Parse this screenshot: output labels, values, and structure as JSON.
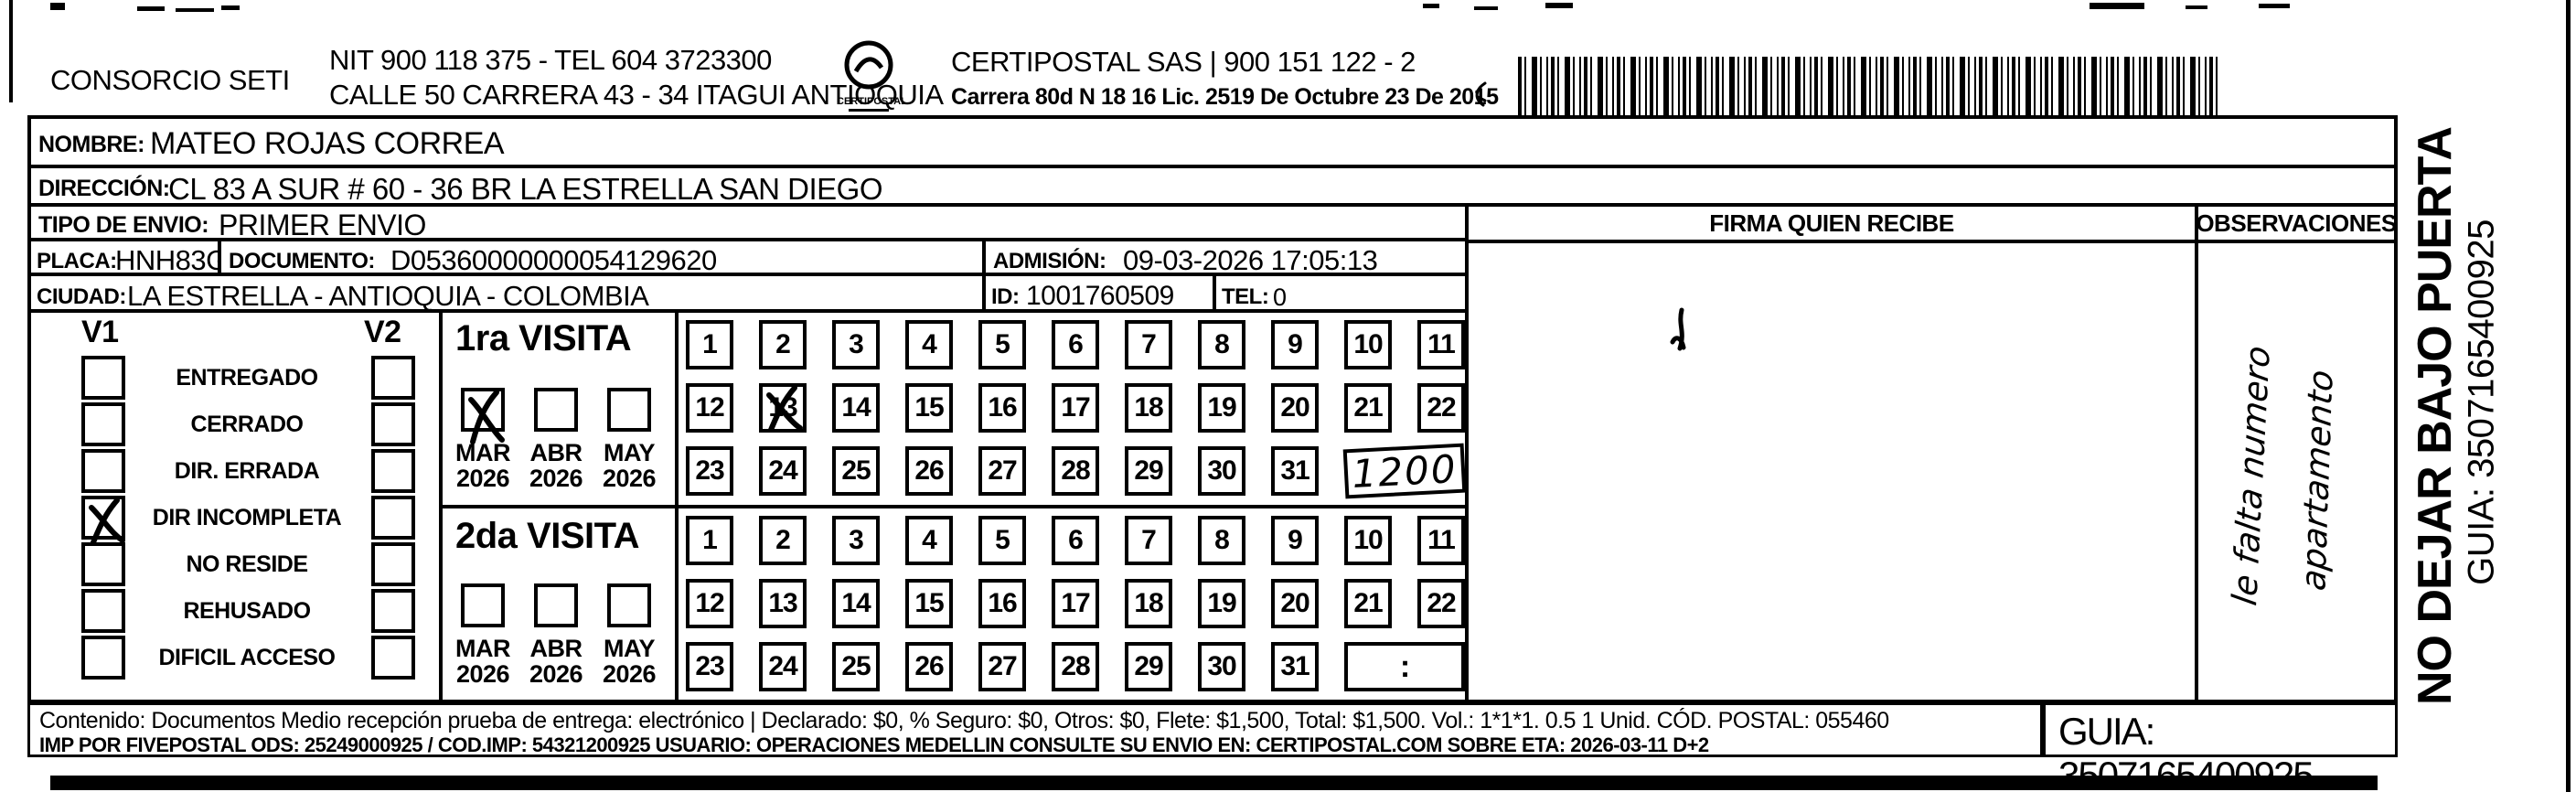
{
  "header": {
    "company": "CONSORCIO SETI",
    "nit_line": "NIT 900 118 375 - TEL 604 3723300",
    "address_line": "CALLE 50 CARRERA 43 - 34 ITAGUI ANTIOQUIA",
    "logo_text": "CERTIPOSTAL",
    "certipostal_line": "CERTIPOSTAL SAS | 900 151 122 - 2",
    "license_line": "Carrera 80d N 18 16  Lic. 2519 De Octubre 23 De 2015"
  },
  "shipment": {
    "nombre_label": "NOMBRE:",
    "nombre": "MATEO ROJAS CORREA",
    "direccion_label": "DIRECCIÓN:",
    "direccion": "CL 83 A SUR # 60 - 36 BR LA ESTRELLA SAN DIEGO",
    "tipo_label": "TIPO DE ENVIO:",
    "tipo": "PRIMER ENVIO",
    "placa_label": "PLACA:",
    "placa": "HNH83G",
    "documento_label": "DOCUMENTO:",
    "documento": "D05360000000054129620",
    "admision_label": "ADMISIÓN:",
    "admision": "09-03-2026 17:05:13",
    "ciudad_label": "CIUDAD:",
    "ciudad": "LA ESTRELLA - ANTIOQUIA - COLOMBIA",
    "id_label": "ID:",
    "id_value": "1001760509",
    "tel_label": "TEL:",
    "tel": "0"
  },
  "delivery_status": {
    "col1": "V1",
    "col2": "V2",
    "options": [
      "ENTREGADO",
      "CERRADO",
      "DIR. ERRADA",
      "DIR INCOMPLETA",
      "NO RESIDE",
      "REHUSADO",
      "DIFICIL ACCESO"
    ],
    "v1_checked_option": "DIR INCOMPLETA"
  },
  "visits": {
    "first": {
      "title": "1ra VISITA",
      "months": [
        "MAR",
        "ABR",
        "MAY"
      ],
      "years": [
        "2026",
        "2026",
        "2026"
      ],
      "checked_month": "MAR",
      "day_rows": [
        [
          "1",
          "2",
          "3",
          "4",
          "5",
          "6",
          "7",
          "8",
          "9",
          "10",
          "11"
        ],
        [
          "12",
          "13",
          "14",
          "15",
          "16",
          "17",
          "18",
          "19",
          "20",
          "21",
          "22"
        ],
        [
          "23",
          "24",
          "25",
          "26",
          "27",
          "28",
          "29",
          "30",
          "31"
        ]
      ],
      "crossed_day": "13",
      "time_written": "1200",
      "time_is_handwritten": true
    },
    "second": {
      "title": "2da VISITA",
      "months": [
        "MAR",
        "ABR",
        "MAY"
      ],
      "years": [
        "2026",
        "2026",
        "2026"
      ],
      "checked_month": "",
      "day_rows": [
        [
          "1",
          "2",
          "3",
          "4",
          "5",
          "6",
          "7",
          "8",
          "9",
          "10",
          "11"
        ],
        [
          "12",
          "13",
          "14",
          "15",
          "16",
          "17",
          "18",
          "19",
          "20",
          "21",
          "22"
        ],
        [
          "23",
          "24",
          "25",
          "26",
          "27",
          "28",
          "29",
          "30",
          "31"
        ]
      ],
      "crossed_day": "",
      "time_written": ":",
      "time_is_handwritten": false
    }
  },
  "signature": {
    "firma_header": "FIRMA QUIEN RECIBE"
  },
  "observations": {
    "header": "OBSERVACIONES",
    "handwritten_line1": "le falta numero",
    "handwritten_line2": "apartamento"
  },
  "side_labels": {
    "no_dejar": "NO DEJAR BAJO PUERTA",
    "guia": "GUIA: 3507165400925"
  },
  "footer": {
    "line1": "Contenido: Documentos Medio recepción prueba de entrega: electrónico | Declarado: $0, % Seguro: $0, Otros: $0, Flete: $1,500, Total: $1,500. Vol.: 1*1*1. 0.5  1 Unid. CÓD. POSTAL: 055460",
    "line2": "IMP POR FIVEPOSTAL ODS: 25249000925 / COD.IMP: 54321200925 USUARIO: OPERACIONES MEDELLIN CONSULTE SU ENVIO EN: CERTIPOSTAL.COM SOBRE ETA: 2026-03-11 D+2",
    "guia_box": "GUIA: 3507165400925"
  },
  "colors": {
    "ink": "#000000",
    "paper": "#ffffff"
  }
}
